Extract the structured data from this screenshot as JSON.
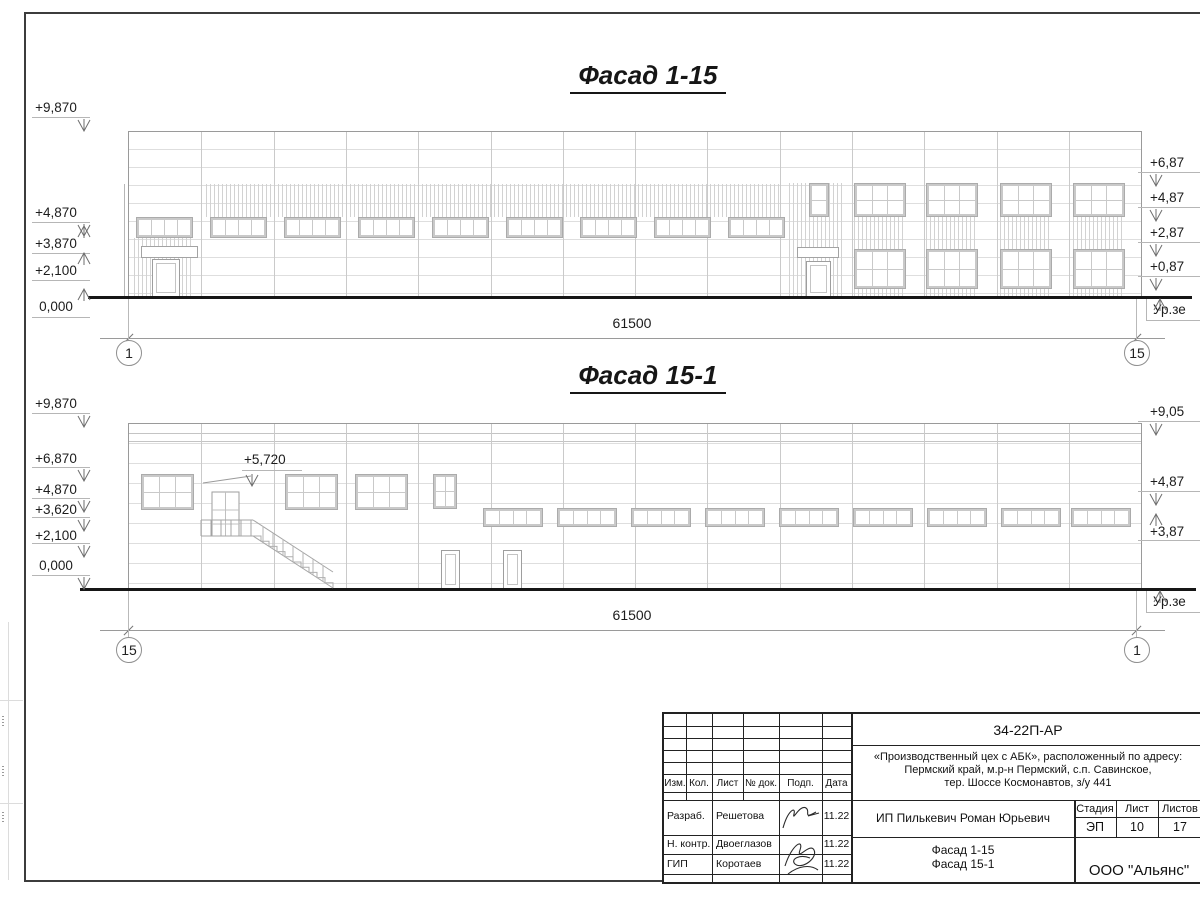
{
  "sheet": {
    "facades": [
      {
        "id": "facade-1-15",
        "title": "Фасад 1-15",
        "left_marks": [
          "+9,870",
          "+4,870",
          "+3,870",
          "+2,100",
          "0,000"
        ],
        "right_marks": [
          "+6,87",
          "+4,87",
          "+2,87",
          "+0,87"
        ],
        "ground_label": "Ур.зе",
        "dimension": "61500",
        "axis_left": "1",
        "axis_right": "15"
      },
      {
        "id": "facade-15-1",
        "title": "Фасад 15-1",
        "left_marks": [
          "+9,870",
          "+6,870",
          "+4,870",
          "+3,620",
          "+2,100",
          "0,000"
        ],
        "right_marks": [
          "+9,05",
          "+4,87",
          "+3,87"
        ],
        "stair_mark": "+5,720",
        "ground_label": "Ур.зе",
        "dimension": "61500",
        "axis_left": "15",
        "axis_right": "1"
      }
    ]
  },
  "title_block": {
    "doc_code": "34-22П-АР",
    "project_lines": [
      "«Производственный цех с АБК», расположенный по адресу:",
      "Пермский край, м.р-н Пермский, с.п. Савинское,",
      "тер. Шоссе Космонавтов, з/у 441"
    ],
    "table_headers": [
      "Изм.",
      "Кол.",
      "Лист",
      "№ док.",
      "Подп.",
      "Дата"
    ],
    "signature_rows": [
      {
        "role": "Разраб.",
        "name": "Решетова",
        "date": "11.22"
      },
      {
        "role": "Н. контр.",
        "name": "Двоеглазов",
        "date": "11.22"
      },
      {
        "role": "ГИП",
        "name": "Коротаев",
        "date": "11.22"
      }
    ],
    "client": "ИП Пилькевич Роман Юрьевич",
    "stage_headers": [
      "Стадия",
      "Лист",
      "Листов"
    ],
    "stage_values": [
      "ЭП",
      "10",
      "17"
    ],
    "sheet_title_lines": [
      "Фасад 1-15",
      "Фасад 15-1"
    ],
    "organization": "ООО \"Альянс\""
  }
}
